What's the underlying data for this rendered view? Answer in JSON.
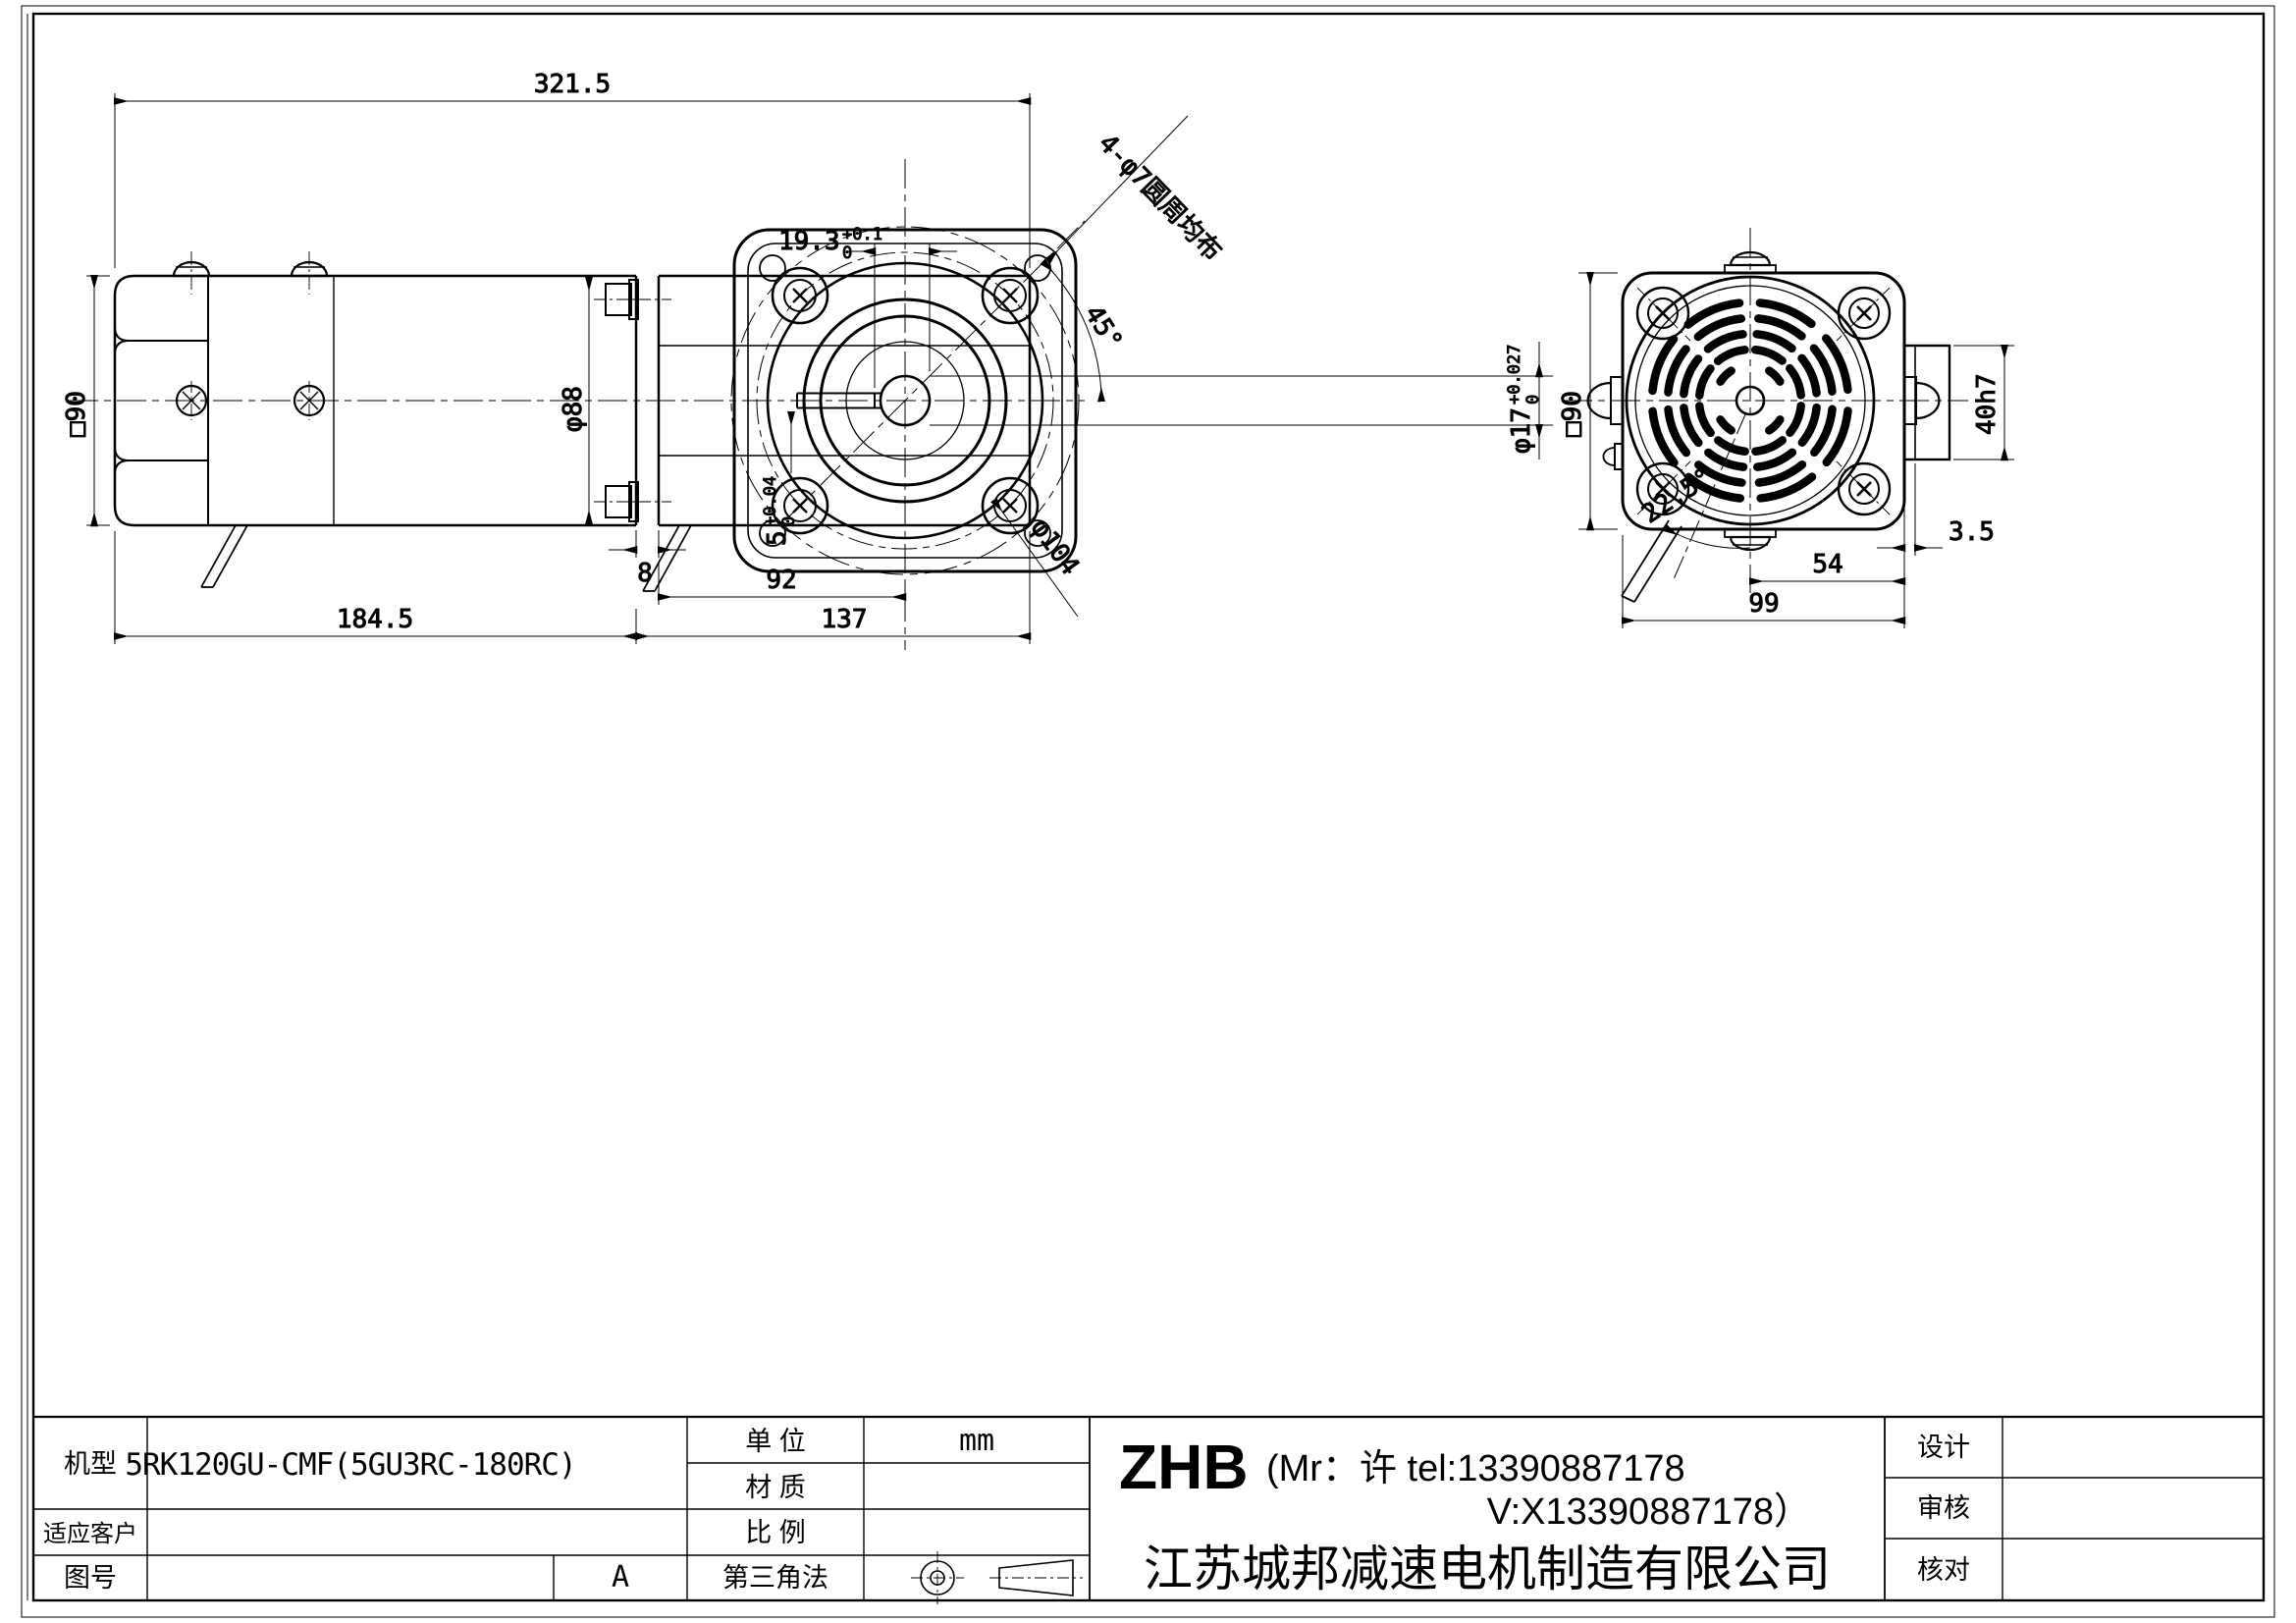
{
  "drawing": {
    "top_total_length": "321.5",
    "side_view": {
      "motor_square": "□90",
      "motor_diameter": "φ88",
      "motor_length": "184.5",
      "gearbox_length": "137",
      "shaft_center_offset": "92",
      "joint_gap": "8"
    },
    "flange_view": {
      "keyway_depth": "19.3",
      "keyway_depth_tol_up": "+0.1",
      "keyway_depth_tol_dn": "0",
      "bolt_angle": "45°",
      "bore_dia": "φ17",
      "bore_tol_up": "+0.027",
      "bore_tol_dn": "0",
      "keyway_width": "5",
      "keyway_width_tol_up": "+0.04",
      "keyway_width_tol_dn": "0",
      "bolt_circle_dia": "φ104",
      "holes_note": "4-φ7圆周均布"
    },
    "rear_view": {
      "body_square": "□90",
      "vent_angle": "22.5°",
      "center_to_edge": "54",
      "plate_thickness": "3.5",
      "total_width": "99",
      "boss_dia": "40h7"
    }
  },
  "title_block": {
    "model_label": "机型",
    "model_value": "5RK120GU-CMF(5GU3RC-180RC)",
    "customer_label": "适应客户",
    "drawing_no_label": "图号",
    "revision": "A",
    "unit_label": "单  位",
    "unit_value": "mm",
    "material_label": "材  质",
    "scale_label": "比  例",
    "projection_label": "第三角法",
    "brand": "ZHB",
    "contact_line1": "(Mr：许 tel:13390887178",
    "contact_line2": "V:X13390887178）",
    "company": "江苏城邦减速电机制造有限公司",
    "design_label": "设计",
    "review_label": "审核",
    "check_label": "核对"
  }
}
